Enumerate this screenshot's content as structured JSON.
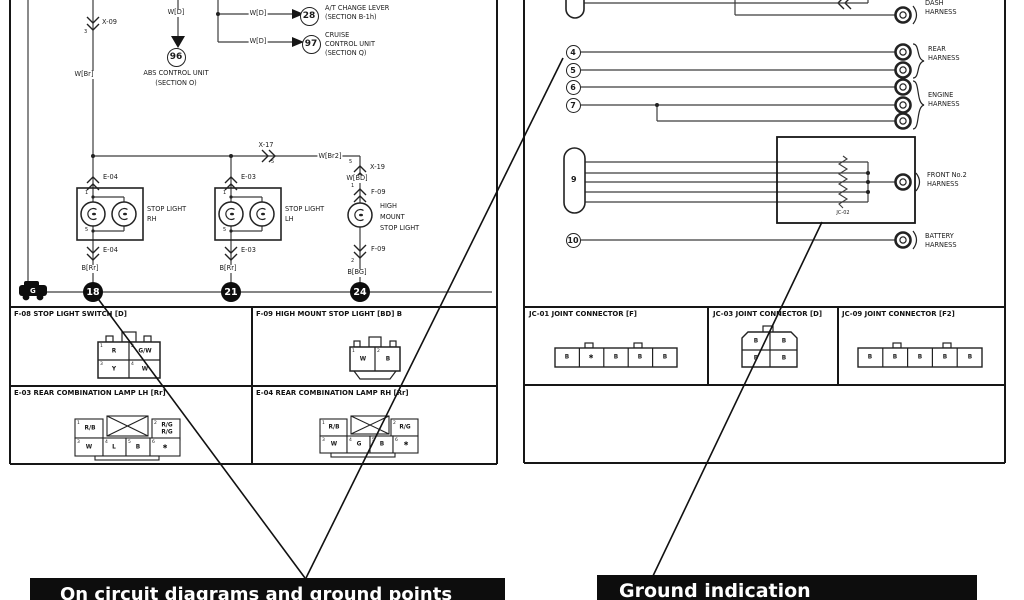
{
  "colors": {
    "wire": "#3c3c3c",
    "border": "#161616",
    "bar_bg": "#0d0d0d",
    "bar_text": "#ffffff"
  },
  "callouts": {
    "left": "On circuit diagrams and ground points",
    "right": "Ground indication"
  },
  "lp": {
    "x09": "X-09",
    "x09_pin": "3",
    "w_br": "W[Br]",
    "w_d": "W[D]",
    "ref28": "28",
    "at1": "A/T CHANGE LEVER",
    "at2": "(SECTION B-1h)",
    "ref97": "97",
    "cr1": "CRUISE",
    "cr2": "CONTROL UNIT",
    "cr3": "(SECTION Q)",
    "ref96": "96",
    "abs1": "ABS CONTROL UNIT",
    "abs2": "(SECTION O)",
    "x17": "X-17",
    "x17_pin": "5",
    "w_br2": "W[Br2]",
    "x19": "X-19",
    "x19_pin": "5",
    "w_bd": "W[BD]",
    "g": "G",
    "rh": {
      "conn": "E-04",
      "pin1": "1",
      "pin2": "5",
      "n1": "STOP LIGHT",
      "n2": "RH",
      "wire": "B[Rr]",
      "gnd": "18"
    },
    "lh": {
      "conn": "E-03",
      "pin1": "1",
      "pin2": "5",
      "n1": "STOP LIGHT",
      "n2": "LH",
      "wire": "B[Rr]",
      "gnd": "21"
    },
    "hm": {
      "conn": "F-09",
      "pin1": "1",
      "pin2": "2",
      "n1": "HIGH",
      "n2": "MOUNT",
      "n3": "STOP LIGHT",
      "wire": "B[BG]",
      "gnd": "24"
    }
  },
  "rp": {
    "dash1": "DASH",
    "dash2": "HARNESS",
    "rear1": "REAR",
    "rear2": "HARNESS",
    "eng1": "ENGINE",
    "eng2": "HARNESS",
    "front1": "FRONT No.2",
    "front2": "HARNESS",
    "bat1": "BATTERY",
    "bat2": "HARNESS",
    "c4": "4",
    "c5": "5",
    "c6": "6",
    "c7": "7",
    "c10": "10",
    "pill9": "9",
    "jc02": "JC-02"
  },
  "cd": {
    "f08": {
      "title": "F-08 STOP LIGHT SWITCH [D]",
      "pins": [
        "1",
        "2",
        "3",
        "4"
      ],
      "cells": [
        "R",
        "G/W",
        "Y",
        "W"
      ]
    },
    "f09": {
      "title": "F-09 HIGH MOUNT STOP LIGHT [BD] B",
      "pins": [
        "1",
        "2"
      ],
      "cells": [
        "W",
        "B"
      ]
    },
    "e03": {
      "title": "E-03 REAR COMBINATION LAMP LH [Rr]",
      "pins": [
        "1",
        "2",
        "3",
        "4",
        "5",
        "6"
      ],
      "top1": "R/B",
      "top2a": "R/G",
      "top2b": "R/G",
      "b1": "W",
      "b2": "L",
      "b3": "B",
      "b4": "✱"
    },
    "e04": {
      "title": "E-04 REAR COMBINATION LAMP RH [Rr]",
      "pins": [
        "1",
        "2",
        "3",
        "4",
        "5",
        "6"
      ],
      "top1": "R/B",
      "top2": "R/G",
      "b1": "W",
      "b2": "G",
      "b3": "B",
      "b4": "✱"
    },
    "jc01": {
      "title": "JC-01 JOINT CONNECTOR [F]",
      "cells": [
        "B",
        "✱",
        "B",
        "B",
        "B"
      ]
    },
    "jc03": {
      "title": "JC-03 JOINT CONNECTOR [D]",
      "cells": [
        "B",
        "B",
        "B",
        "B"
      ]
    },
    "jc09": {
      "title": "JC-09 JOINT CONNECTOR [F2]",
      "cells": [
        "B",
        "B",
        "B",
        "B",
        "B"
      ]
    }
  }
}
